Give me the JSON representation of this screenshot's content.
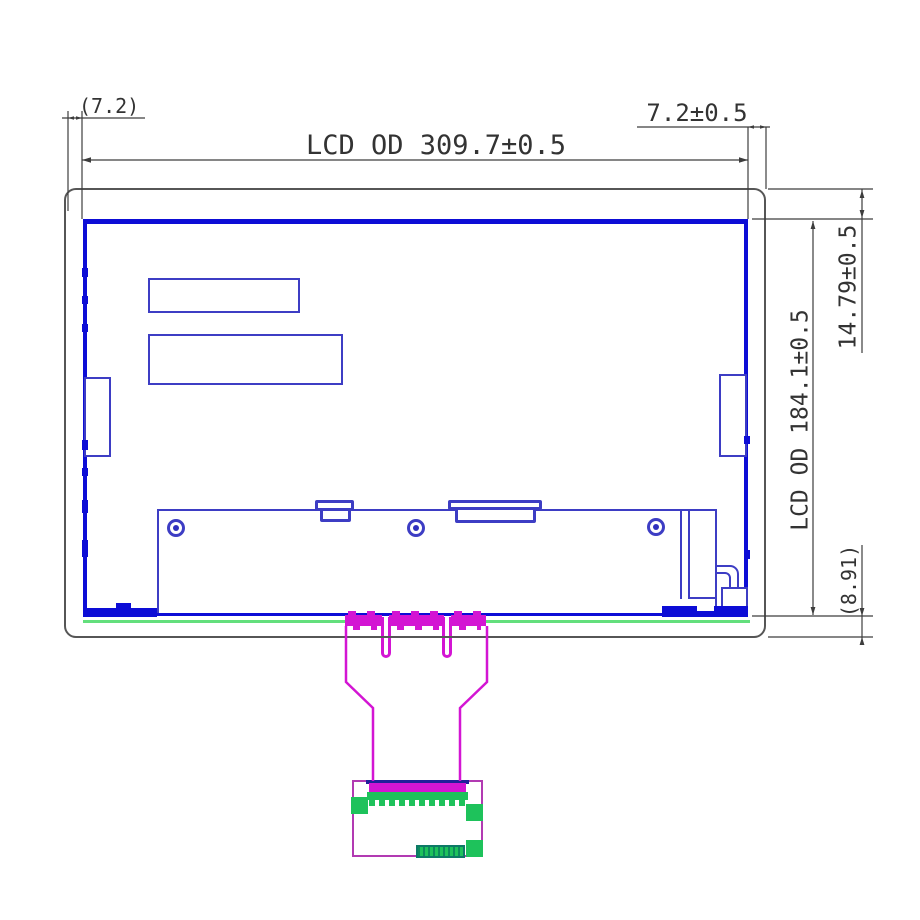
{
  "drawing": {
    "type": "LCD module outline dimension drawing",
    "dimensions": {
      "left_offset_ref": "(7.2)",
      "right_offset": "7.2±0.5",
      "lcd_outline_width": "LCD OD 309.7±0.5",
      "top_margin": "14.79±0.5",
      "lcd_outline_height": "LCD OD 184.1±0.5",
      "bottom_margin_ref": "(8.91)"
    },
    "connectors": {
      "cn1_label": "CN1",
      "cn2_label": "CN2"
    },
    "colors": {
      "panel_blue": "#0d0dd6",
      "component_blue": "#3d3dc4",
      "label_blue": "#2323cf",
      "dim_gray": "#3d3d3d",
      "frame_gray": "#565656",
      "fpc_magenta": "#d315d3",
      "board_purple": "#b23ab2",
      "gasket_green": "#63df7c",
      "pad_green": "#1ec25b",
      "teal": "#0d7a66",
      "navy": "#20209a",
      "text_gray": "#333333"
    }
  }
}
